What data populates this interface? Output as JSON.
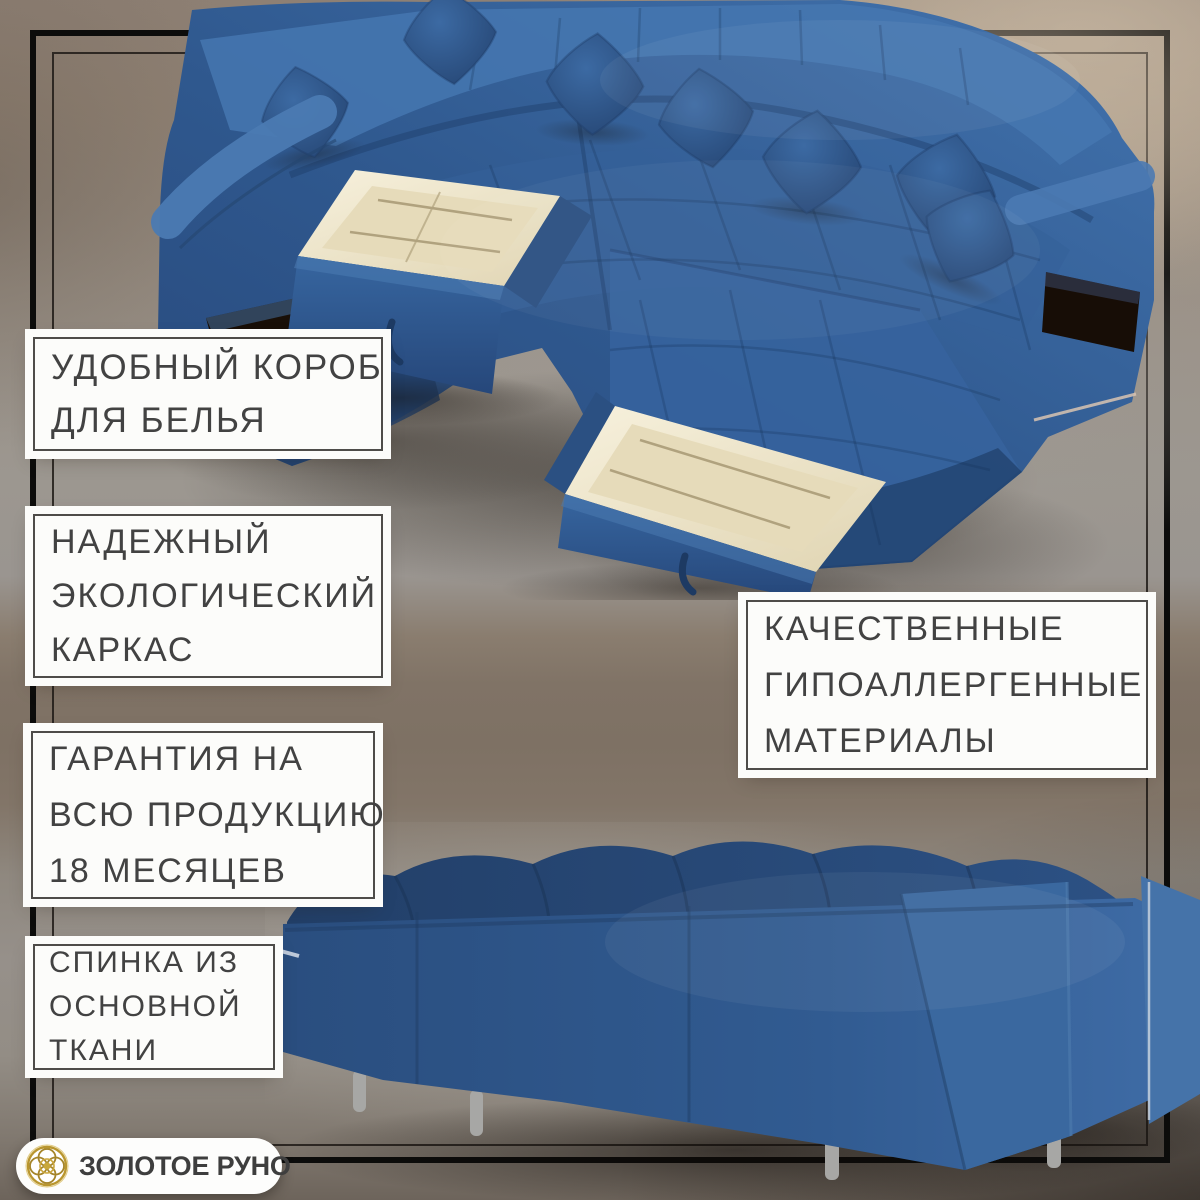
{
  "brand": {
    "name": "ЗОЛОТОЕ РУНО",
    "icon": "golden-rosette-icon",
    "gold": "#b6953a",
    "text_color": "#3e3e3e"
  },
  "features": [
    {
      "id": "laundry-box",
      "lines": [
        "УДОБНЫЙ КОРОБ",
        "ДЛЯ БЕЛЬЯ"
      ]
    },
    {
      "id": "eco-frame",
      "lines": [
        "НАДЕЖНЫЙ",
        "ЭКОЛОГИЧЕСКИЙ",
        "КАРКАС"
      ]
    },
    {
      "id": "warranty-18-months",
      "lines": [
        "ГАРАНТИЯ НА",
        "ВСЮ ПРОДУКЦИЮ",
        "18 МЕСЯЦЕВ"
      ]
    },
    {
      "id": "hypoallergenic-materials",
      "lines": [
        "КАЧЕСТВЕННЫЕ",
        "ГИПОАЛЛЕРГЕННЫЕ",
        "МАТЕРИАЛЫ"
      ]
    },
    {
      "id": "backrest-main-fabric",
      "lines": [
        "СПИНКА ИЗ",
        "ОСНОВНОЙ",
        "ТКАНИ"
      ]
    }
  ],
  "photos": {
    "front": "sofa-front-view-with-open-storage-drawers",
    "back": "sofa-back-view"
  },
  "palette": {
    "sofa_blue": "#30598f",
    "sofa_blue_light": "#4273ae",
    "sofa_blue_dark": "#23426f",
    "drawer_interior": "#eee4c9",
    "frame_black": "#0c0c0b",
    "callout_bg": "#fcfcfa",
    "callout_border": "#4e4c49",
    "callout_text": "#424242",
    "backdrop_warm": "#8e8074",
    "backdrop_gray": "#9a9590",
    "backdrop_beige": "#b2a494"
  }
}
